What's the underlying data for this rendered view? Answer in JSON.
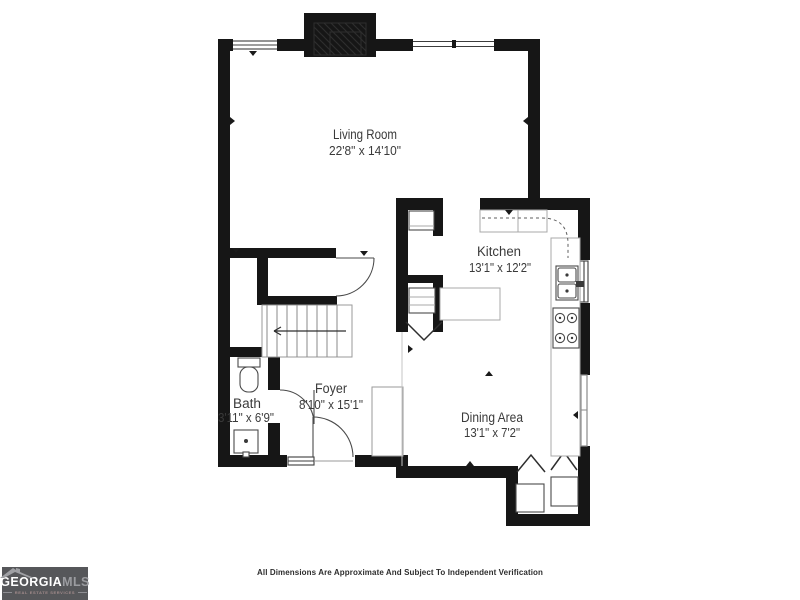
{
  "colors": {
    "walls": "#161616",
    "label_text": "#3a3a3a",
    "logo_background": "#56575a"
  },
  "floor_plan": {
    "rooms": [
      {
        "name": "Living Room",
        "dimensions": "22'8\" x 14'10\""
      },
      {
        "name": "Kitchen",
        "dimensions": "13'1\" x 12'2\""
      },
      {
        "name": "Bath",
        "dimensions": "3'11\" x 6'9\""
      },
      {
        "name": "Foyer",
        "dimensions": "8'10\" x 15'1\""
      },
      {
        "name": "Dining Area",
        "dimensions": "13'1\" x 7'2\""
      }
    ],
    "features": [
      "fireplace",
      "windows",
      "staircase-down-arrow",
      "under-stair-closet",
      "pantry-closets",
      "kitchen-island",
      "kitchen-counters",
      "double-sink",
      "stove-four-burners",
      "toilet",
      "bathroom-vanity",
      "foyer-closet",
      "entry-door",
      "sliding-glass-door",
      "laundry-appliance-nook",
      "bifold-doors"
    ]
  },
  "footer": {
    "disclaimer": "All Dimensions Are Approximate And Subject To Independent Verification"
  },
  "logo": {
    "brand_primary": "GEORGIA",
    "brand_secondary": "MLS",
    "tagline": "REAL ESTATE SERVICES"
  }
}
